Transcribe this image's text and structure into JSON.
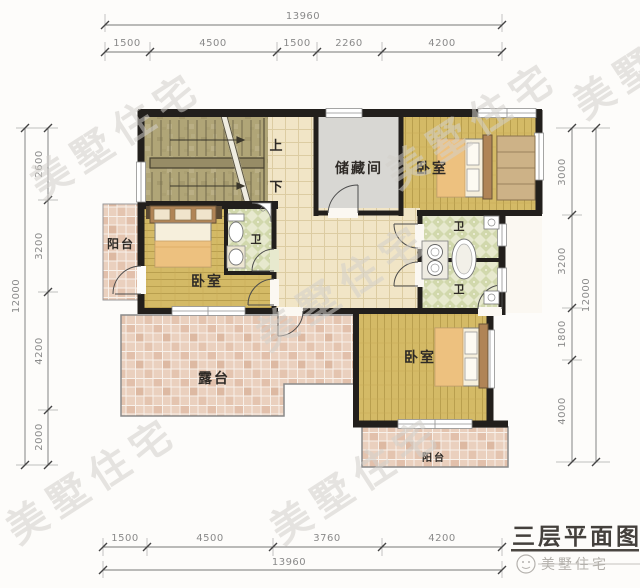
{
  "colors": {
    "wall": "#221f1c",
    "wood": "#d4ba66",
    "wood_line": "#b99f4e",
    "olive": "#b0a577",
    "cream_tile": "#f1e5c6",
    "pink_tile": "#ead0be",
    "bath_tile": "#e7e9ce",
    "storage_gray": "#d8d7d3",
    "dim_text": "#8a8a8a",
    "label_text": "#2e2a26",
    "watermark": "#d3d0cb",
    "title_text": "#44403c",
    "brand_text": "#b3b0ab"
  },
  "watermark": {
    "text": "美墅住宅"
  },
  "title_block": {
    "title": "三层平面图",
    "brand": "美墅住宅"
  },
  "dimensions": {
    "top": {
      "total": "13960",
      "segments": [
        "1500",
        "4500",
        "1500",
        "2260",
        "4200"
      ]
    },
    "bottom": {
      "total": "13960",
      "segments": [
        "1500",
        "4500",
        "3760",
        "4200"
      ]
    },
    "left": {
      "total": "12000",
      "segments": [
        "2600",
        "3200",
        "4200",
        "2000"
      ]
    },
    "right": {
      "total": "12000",
      "segments": [
        "3000",
        "3200",
        "1800",
        "4000"
      ]
    }
  },
  "rooms": {
    "storage": {
      "label": "储藏间"
    },
    "bedroom_top": {
      "label": "卧室"
    },
    "bedroom_left": {
      "label": "卧室"
    },
    "bedroom_bottom": {
      "label": "卧室"
    },
    "bath_left": {
      "label": "卫"
    },
    "bath_upper": {
      "label": "卫"
    },
    "bath_lower": {
      "label": "卫"
    },
    "balcony_left": {
      "label": "阳台"
    },
    "balcony_bottom": {
      "label": "阳台"
    },
    "terrace": {
      "label": "露台"
    },
    "stair_up": {
      "label": "上"
    },
    "stair_down": {
      "label": "下"
    }
  }
}
